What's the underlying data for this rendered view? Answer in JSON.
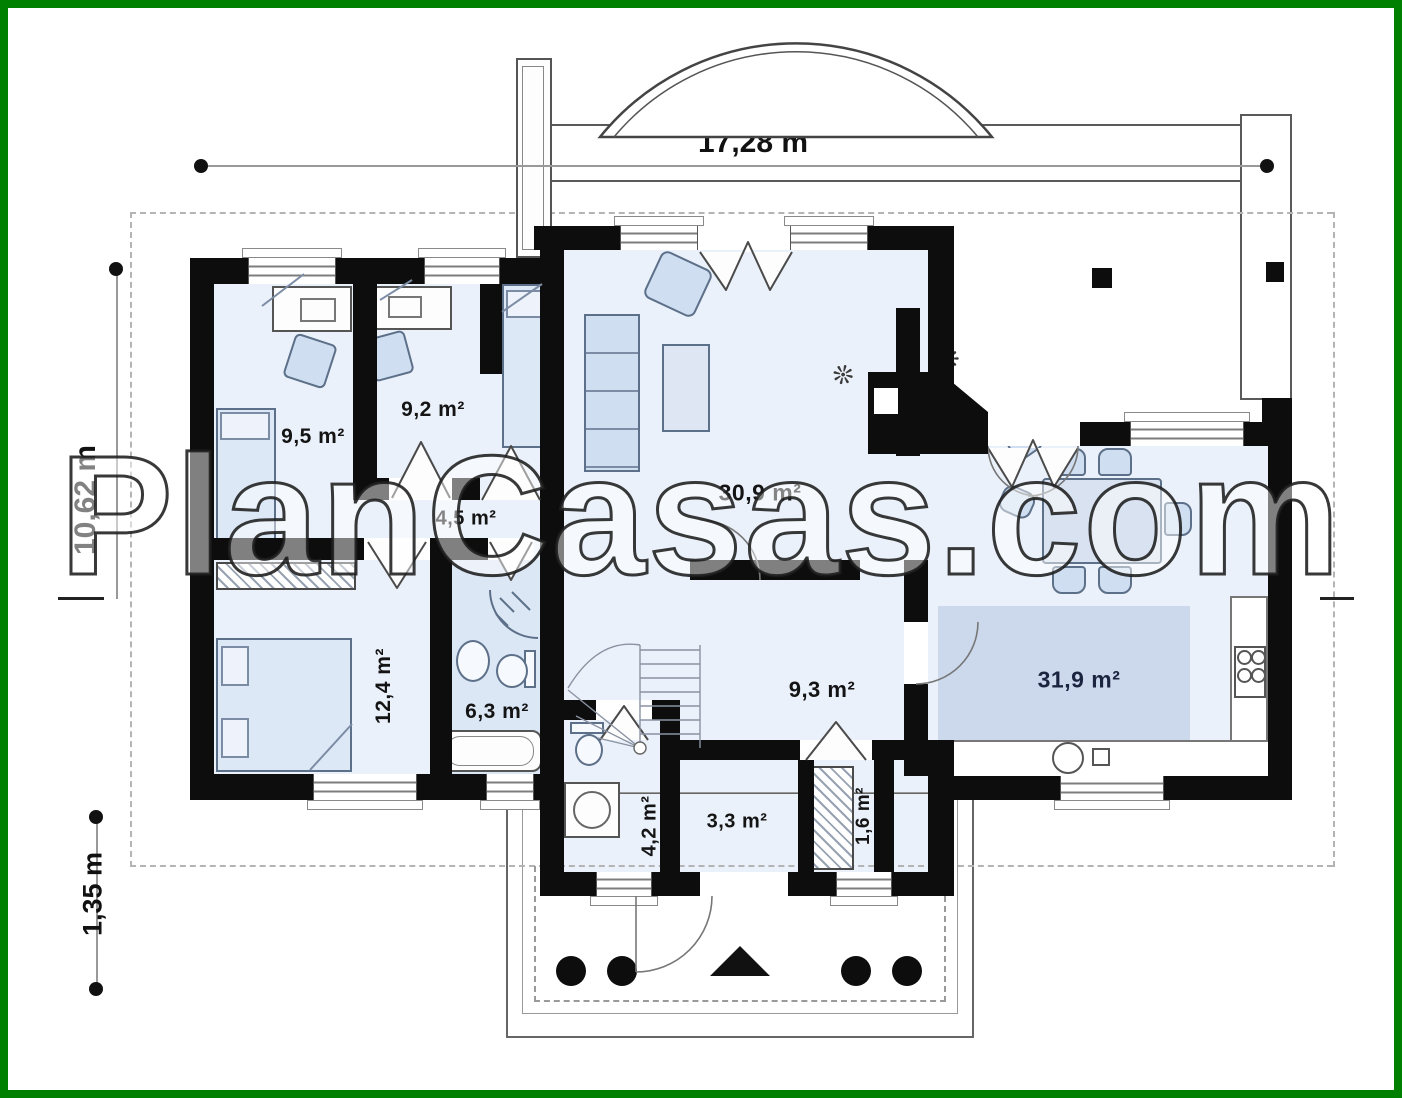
{
  "watermark": {
    "text": "PlanCasas.com"
  },
  "dimensions": {
    "width": "17,28 m",
    "height": "10,62 m",
    "porch_depth": "1,35 m"
  },
  "rooms": [
    {
      "name": "bedroom-top-left",
      "area": "9,5 m²"
    },
    {
      "name": "bedroom-top-middle",
      "area": "9,2 m²"
    },
    {
      "name": "hallway",
      "area": "4,5 m²"
    },
    {
      "name": "living-room",
      "area": "30,9 m²"
    },
    {
      "name": "bedroom-bottom",
      "area": "12,4 m²"
    },
    {
      "name": "bathroom",
      "area": "6,3 m²"
    },
    {
      "name": "hall",
      "area": "9,3 m²"
    },
    {
      "name": "kitchen-dining",
      "area": "31,9 m²"
    },
    {
      "name": "wc",
      "area": "4,2 m²"
    },
    {
      "name": "entry",
      "area": "3,3 m²"
    },
    {
      "name": "closet",
      "area": "1,6 m²"
    }
  ],
  "colors": {
    "frame": "#008001",
    "wall": "#0d0d0d",
    "floor": "#ebf1fa",
    "kitchen_accent": "#ccd9ed",
    "bath_floor": "#dce7f5",
    "furniture": "#cfdff1"
  }
}
